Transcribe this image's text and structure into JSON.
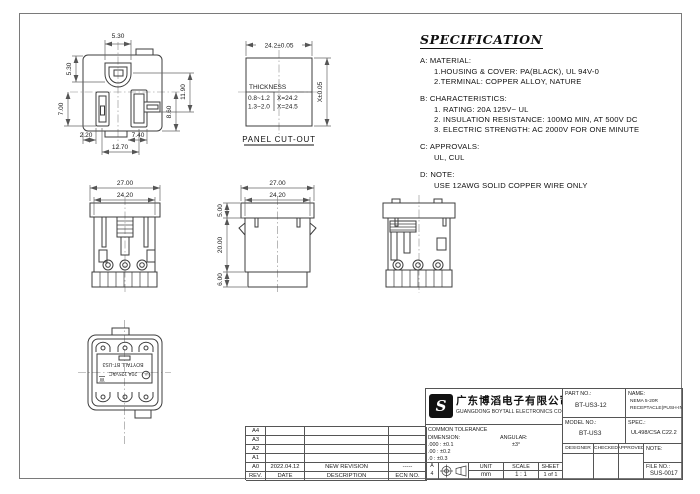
{
  "drawings": {
    "front_face": {
      "dim_top": "5.30",
      "dim_left_upper": "5.30",
      "dim_left_lower": "7.00",
      "dim_right_outer": "11.90",
      "dim_right_inner": "8.60",
      "dim_bottom_left": "2.20",
      "dim_bottom_mid": "7.40",
      "dim_bottom_span": "12.70"
    },
    "panel_cutout": {
      "dim_width": "24.2±0.05",
      "dim_height": "X±0.05",
      "thickness_title": "THICKNESS",
      "row1_range": "0.8~1.2",
      "row1_value": "X=24.2",
      "row2_range": "1.3~2.0",
      "row2_value": "X=24.5",
      "caption": "PANEL CUT-OUT"
    },
    "front_view": {
      "dim_flange": "27.00",
      "dim_body": "24.20"
    },
    "side_view": {
      "dim_flange": "27.00",
      "dim_body": "24.20",
      "dim_height_top": "5.00",
      "dim_height_mid": "20.00",
      "dim_height_bottom": "6.00"
    },
    "bottom_view": {
      "marking_rating": "20A 125VAC",
      "marking_brand": "BOYTALL  BT-US3",
      "marking_ul": "UL",
      "marking_w": "W"
    }
  },
  "specification": {
    "title": "SPECIFICATION",
    "sections": [
      {
        "label": "A:",
        "heading": "MATERIAL:",
        "lines": [
          "1.HOUSING & COVER: PA(BLACK), UL 94V-0",
          "2.TERMINAL: COPPER ALLOY, NATURE"
        ]
      },
      {
        "label": "B:",
        "heading": "CHARACTERISTICS:",
        "lines": [
          "1. RATING: 20A 125V~ UL",
          "2. INSULATION RESISTANCE: 100MΩ MIN, AT 500V DC",
          "3. ELECTRIC STRENGTH: AC 2000V FOR ONE MINUTE"
        ]
      },
      {
        "label": "C:",
        "heading": "APPROVALS:",
        "lines": [
          "UL, CUL"
        ]
      },
      {
        "label": "D:",
        "heading": "NOTE:",
        "lines": [
          "USE 12AWG SOLID COPPER WIRE ONLY"
        ]
      }
    ]
  },
  "revision": {
    "header": {
      "rev": "REV.",
      "date": "DATE",
      "description": "DESCRIPTION",
      "ecn": "ECN NO."
    },
    "rows": [
      {
        "rev": "A4",
        "date": "",
        "description": "",
        "ecn": ""
      },
      {
        "rev": "A3",
        "date": "",
        "description": "",
        "ecn": ""
      },
      {
        "rev": "A2",
        "date": "",
        "description": "",
        "ecn": ""
      },
      {
        "rev": "A1",
        "date": "",
        "description": "",
        "ecn": ""
      },
      {
        "rev": "A0",
        "date": "2022.04.12",
        "description": "NEW REVISION",
        "ecn": "-----"
      }
    ]
  },
  "title_block": {
    "company_cn": "广东博滔电子有限公司",
    "company_en": "GUANGDONG BOYTALL ELECTRONICS CO.,LTD",
    "logo_glyph": "S",
    "part_no_label": "PART NO.:",
    "part_no": "BT-US3-12",
    "name_label": "NAME:",
    "name_line1": "NEMA 5-20R",
    "name_line2": "RECEPTACLE(PUSH-IN)",
    "model_no_label": "MODEL NO.:",
    "model_no": "BT-US3",
    "spec_label": "SPEC.:",
    "spec_value": "UL498/CSA C22.2",
    "tolerance_title": "COMMON TOLERANCE",
    "dimension_label": "DIMENSION:",
    "angular_label": "ANGULAR:",
    "angular_value": "±3°",
    "tol_row1": ".000 : ±0.1",
    "tol_row2": ".00  : ±0.2",
    "tol_row3": ".0   : ±0.3",
    "designer_label": "DESIGNER",
    "checked_label": "CHECKED",
    "approved_label": "APPROVED",
    "note_label": "NOTE:",
    "sheet_size_top": "A",
    "sheet_size_bottom": "4",
    "unit_label": "UNIT",
    "unit_value": "mm",
    "scale_label": "SCALE",
    "scale_value": "1 : 1",
    "sheet_label": "SHEET",
    "sheet_value": "1 of 1",
    "file_no_label": "FILE NO.:",
    "file_no": "SUS-0017"
  }
}
